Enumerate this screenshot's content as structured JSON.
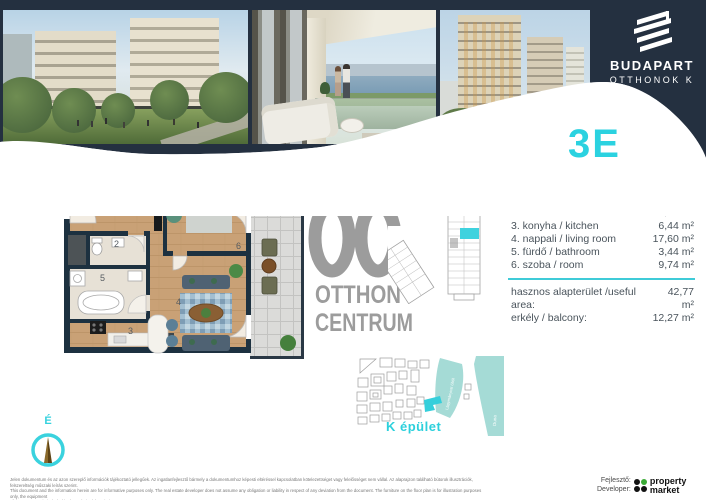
{
  "header": {
    "brand_name": "BUDAPART",
    "brand_sub": "OTTHONOK K",
    "unit_code": "3E"
  },
  "room_list": {
    "rows": [
      {
        "label": "1. előtér / lobby",
        "value": "4,53 m²"
      },
      {
        "label": "2. WC / Toilette",
        "value": "1,02 m²"
      },
      {
        "label": "3. konyha / kitchen",
        "value": "6,44 m²"
      },
      {
        "label": "4. nappali / living room",
        "value": "17,60 m²"
      },
      {
        "label": "5. fürdő / bathroom",
        "value": "3,44 m²"
      },
      {
        "label": "6. szoba / room",
        "value": "9,74 m²"
      }
    ],
    "summary": [
      {
        "label": "hasznos alapterület /useful area:",
        "value": "42,77 m²"
      },
      {
        "label": "erkély / balcony:",
        "value": "12,27 m²"
      }
    ]
  },
  "floorplan": {
    "room_numbers": [
      "1",
      "2",
      "3",
      "4",
      "5",
      "6"
    ]
  },
  "watermark": {
    "line1": "OTTHON",
    "line2": "CENTRUM"
  },
  "siteplan": {
    "building_label": "K épület",
    "bay_label": "Lágymányosi öböl",
    "river_label": "Duna"
  },
  "compass": {
    "north_label": "É"
  },
  "disclaimer": {
    "line1": "Jelen dokumentum és az azon szereplő információk tájékoztató jellegűek. Az ingatlanfejlesztő bármely a dokumentumhoz képesti eltéréssel kapcsolatban kötelezettséget vagy felelősséget nem vállal. Az alaprajzon található bútorok illusztrációk, felszereltség műszaki leírás szerint.",
    "line2": "This document and the information herein are for informative purposes only. The real estate developer does not assume any obligation or liability in respect of any deviation from the document. The furniture on the floor plan is for illustration purposes only, the equipment",
    "line3": "of the apartment is included in the technical description."
  },
  "developer": {
    "label_hu": "Fejlesztő:",
    "label_en": "Developer:",
    "brand_line1": "property",
    "brand_line2": "market"
  },
  "colors": {
    "navy": "#243040",
    "cyan": "#2bd2e0",
    "water": "#a5dbd6",
    "logo_gray": "#9c9c9c",
    "wood": "#c9a176"
  }
}
